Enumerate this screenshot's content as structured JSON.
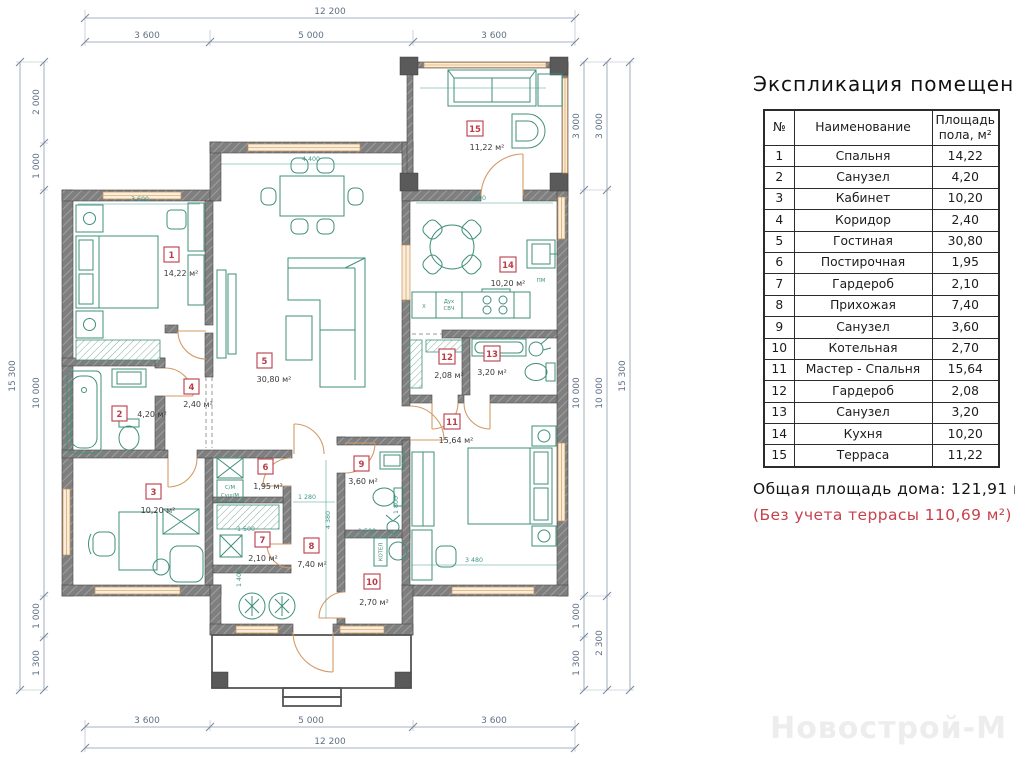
{
  "legend": {
    "title": "Экспликация помещений",
    "col_num": "№",
    "col_name": "Наименование",
    "col_area1": "Площадь",
    "col_area2": "пола, м²",
    "rows": [
      {
        "num": "1",
        "name": "Спальня",
        "area": "14,22"
      },
      {
        "num": "2",
        "name": "Санузел",
        "area": "4,20"
      },
      {
        "num": "3",
        "name": "Кабинет",
        "area": "10,20"
      },
      {
        "num": "4",
        "name": "Коридор",
        "area": "2,40"
      },
      {
        "num": "5",
        "name": "Гостиная",
        "area": "30,80"
      },
      {
        "num": "6",
        "name": "Постирочная",
        "area": "1,95"
      },
      {
        "num": "7",
        "name": "Гардероб",
        "area": "2,10"
      },
      {
        "num": "8",
        "name": "Прихожая",
        "area": "7,40"
      },
      {
        "num": "9",
        "name": "Санузел",
        "area": "3,60"
      },
      {
        "num": "10",
        "name": "Котельная",
        "area": "2,70"
      },
      {
        "num": "11",
        "name": "Мастер - Спальня",
        "area": "15,64"
      },
      {
        "num": "12",
        "name": "Гардероб",
        "area": "2,08"
      },
      {
        "num": "13",
        "name": "Санузел",
        "area": "3,20"
      },
      {
        "num": "14",
        "name": "Кухня",
        "area": "10,20"
      },
      {
        "num": "15",
        "name": "Терраса",
        "area": "11,22"
      }
    ],
    "total": "Общая площадь дома: 121,91 м²",
    "note": "(Без учета террасы 110,69 м²)"
  },
  "watermark": "Новострой-М",
  "plan": {
    "dims": {
      "top_total": "12 200",
      "top": [
        "3 600",
        "5 000",
        "3 600"
      ],
      "bottom": [
        "3 600",
        "5 000",
        "3 600"
      ],
      "bottom_total": "12 200",
      "left_total": "15 300",
      "left": [
        "2 000",
        "1 000",
        "10 000",
        "1 000",
        "1 300"
      ],
      "right_inner": [
        "3 000",
        "10 000",
        "1 000",
        "1 300"
      ],
      "right_mid": [
        "3 000",
        "10 000",
        "2 300"
      ],
      "right_total": "15 300"
    },
    "inner_dims": [
      "3 600",
      "4 400",
      "3 400",
      "3 480",
      "1 500",
      "1 280",
      "1 500",
      "4 380",
      "1 400",
      "1 800"
    ],
    "rooms": [
      {
        "num": "1",
        "area": "14,22 м²"
      },
      {
        "num": "2",
        "area": "4,20 м²"
      },
      {
        "num": "3",
        "area": "10,20 м²"
      },
      {
        "num": "4",
        "area": "2,40 м²"
      },
      {
        "num": "5",
        "area": "30,80 м²"
      },
      {
        "num": "6",
        "area": "1,95 м²"
      },
      {
        "num": "7",
        "area": "2,10 м²"
      },
      {
        "num": "8",
        "area": "7,40 м²"
      },
      {
        "num": "9",
        "area": "3,60 м²"
      },
      {
        "num": "10",
        "area": "2,70 м²"
      },
      {
        "num": "11",
        "area": "15,64 м²"
      },
      {
        "num": "12",
        "area": "2,08 м²"
      },
      {
        "num": "13",
        "area": "3,20 м²"
      },
      {
        "num": "14",
        "area": "10,20 м²"
      },
      {
        "num": "15",
        "area": "11,22 м²"
      }
    ],
    "appliances": {
      "fridge": "Х",
      "oven_top": "Дух",
      "oven_bottom": "СВЧ",
      "dishwasher": "ПМ",
      "washer_top": "С/М",
      "washer_bottom": "Суш/М",
      "boiler": "КОТЕЛ"
    }
  }
}
